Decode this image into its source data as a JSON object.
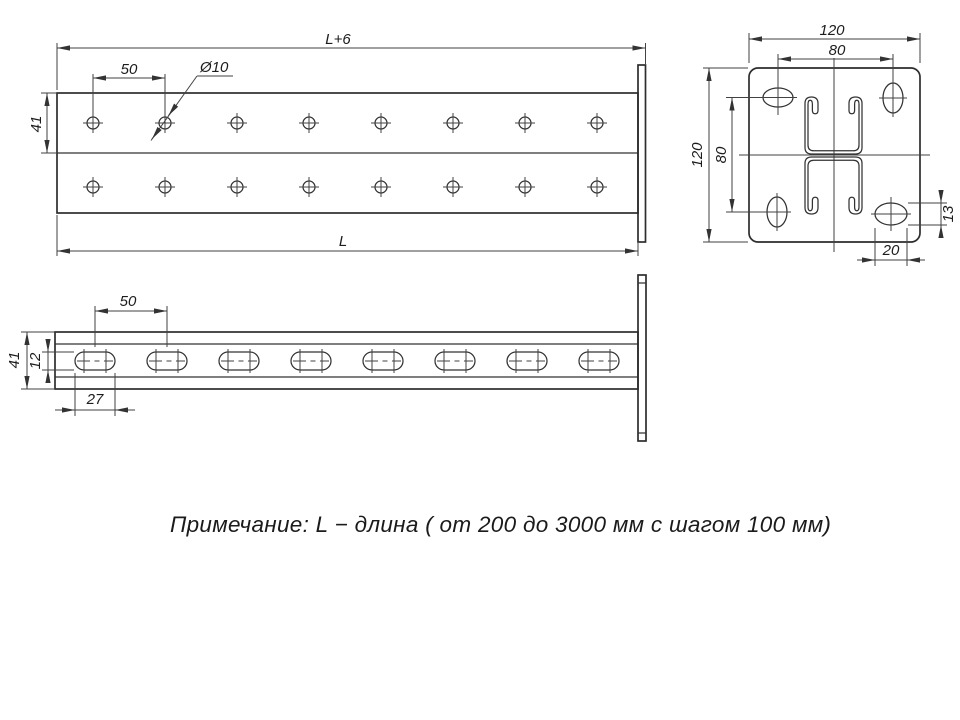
{
  "drawing": {
    "note": "Примечание: L − длина ( от 200 до 3000 мм с шагом 100 мм)",
    "plan_view": {
      "dim_overall_length": "L+6",
      "dim_hole_pitch": "50",
      "dim_hole_diameter": "Ø10",
      "dim_channel_height": "41",
      "dim_length": "L",
      "holes_per_row": 8,
      "hole_rows": 2
    },
    "side_view": {
      "dim_slot_pitch": "50",
      "dim_profile_height": "41",
      "dim_slot_height": "12",
      "dim_slot_length": "27",
      "slot_count": 8
    },
    "end_view": {
      "dim_plate_width": "120",
      "dim_hole_span_horizontal": "80",
      "dim_plate_height": "120",
      "dim_hole_span_vertical": "80",
      "dim_corner_slot_height": "13",
      "dim_corner_slot_width": "20"
    }
  }
}
